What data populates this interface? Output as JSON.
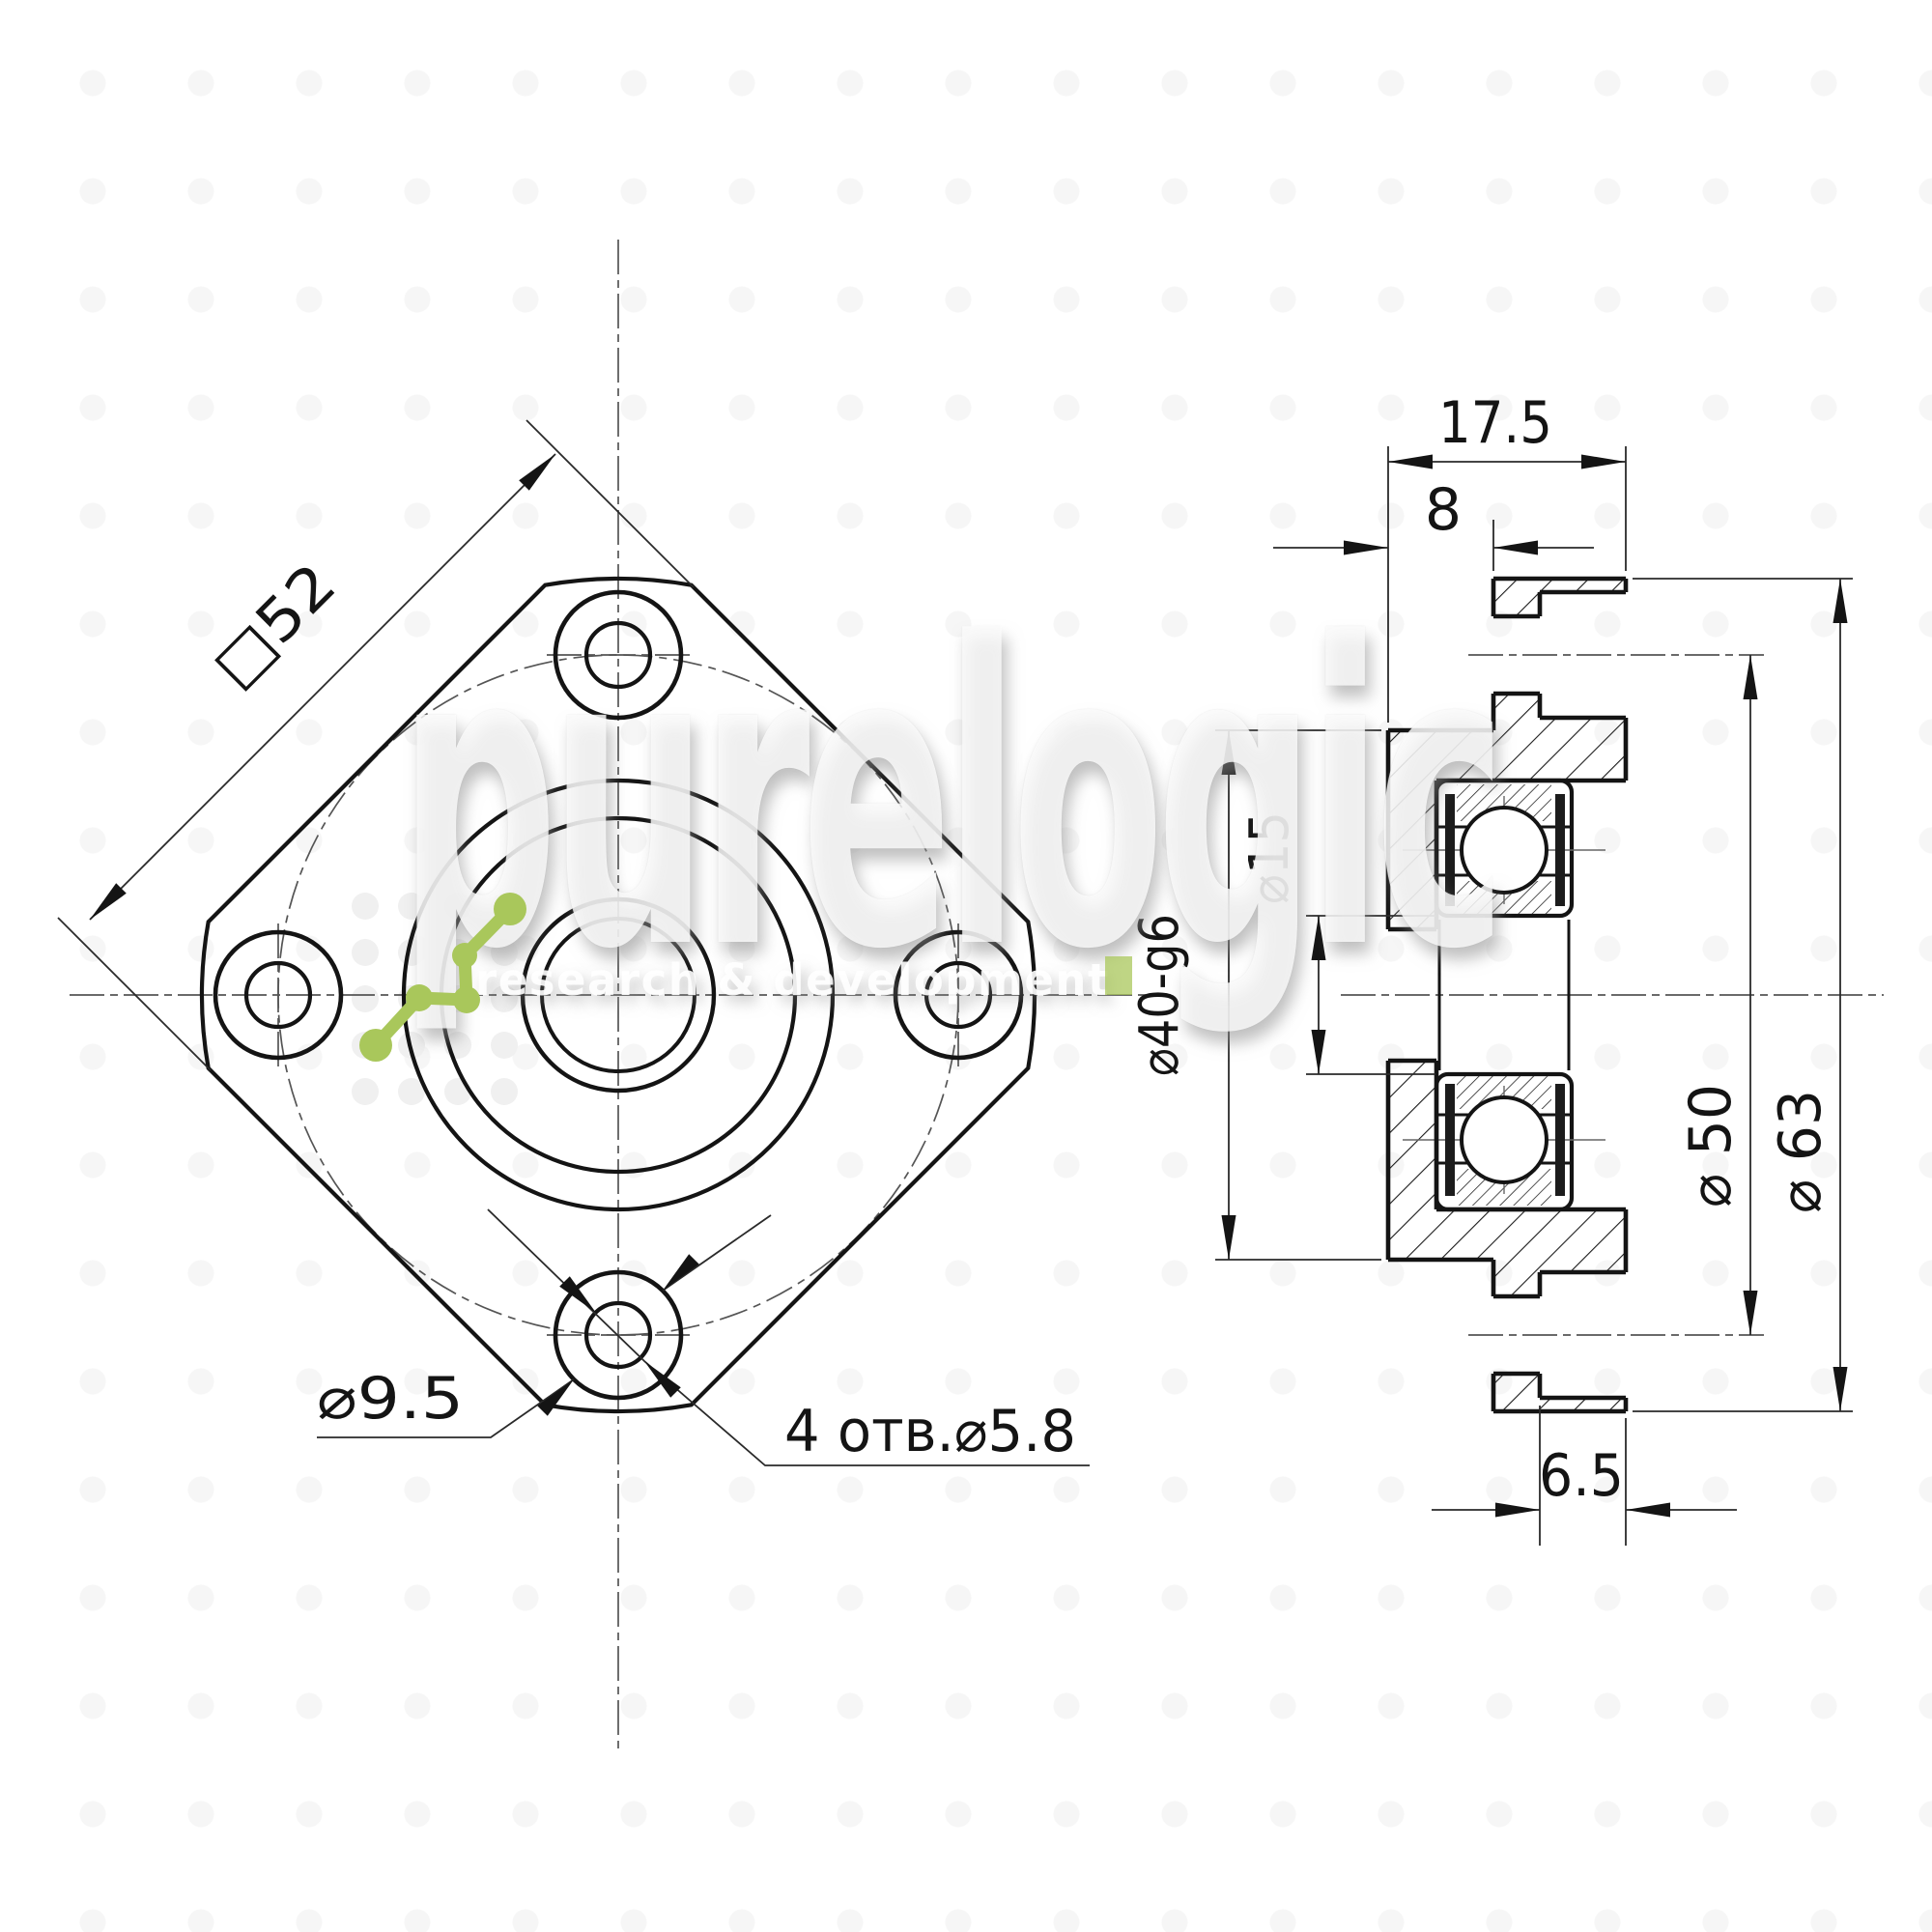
{
  "drawing_title": "bearing support flange - 2 view technical drawing",
  "front_view": {
    "square_label": "□52",
    "cbore_label": "⌀9.5",
    "holes_label": "4 отв.⌀5.8"
  },
  "side_view": {
    "width_label": "17.5",
    "boss_label": "8",
    "bore_label": "⌀15",
    "pilot_label": "⌀40-g6",
    "bolt_circle_label": "⌀ 50",
    "flange_label": "⌀ 63",
    "cbore_depth_label": "6.5"
  },
  "watermark": {
    "brand": "purelogic",
    "tagline": "research & development",
    "brand_green": "#a9c75b"
  },
  "colors": {
    "line": "#141414",
    "thin_line": "#2a2a2a",
    "centerline": "#555555",
    "seal_fill": "#1c1c1c"
  }
}
